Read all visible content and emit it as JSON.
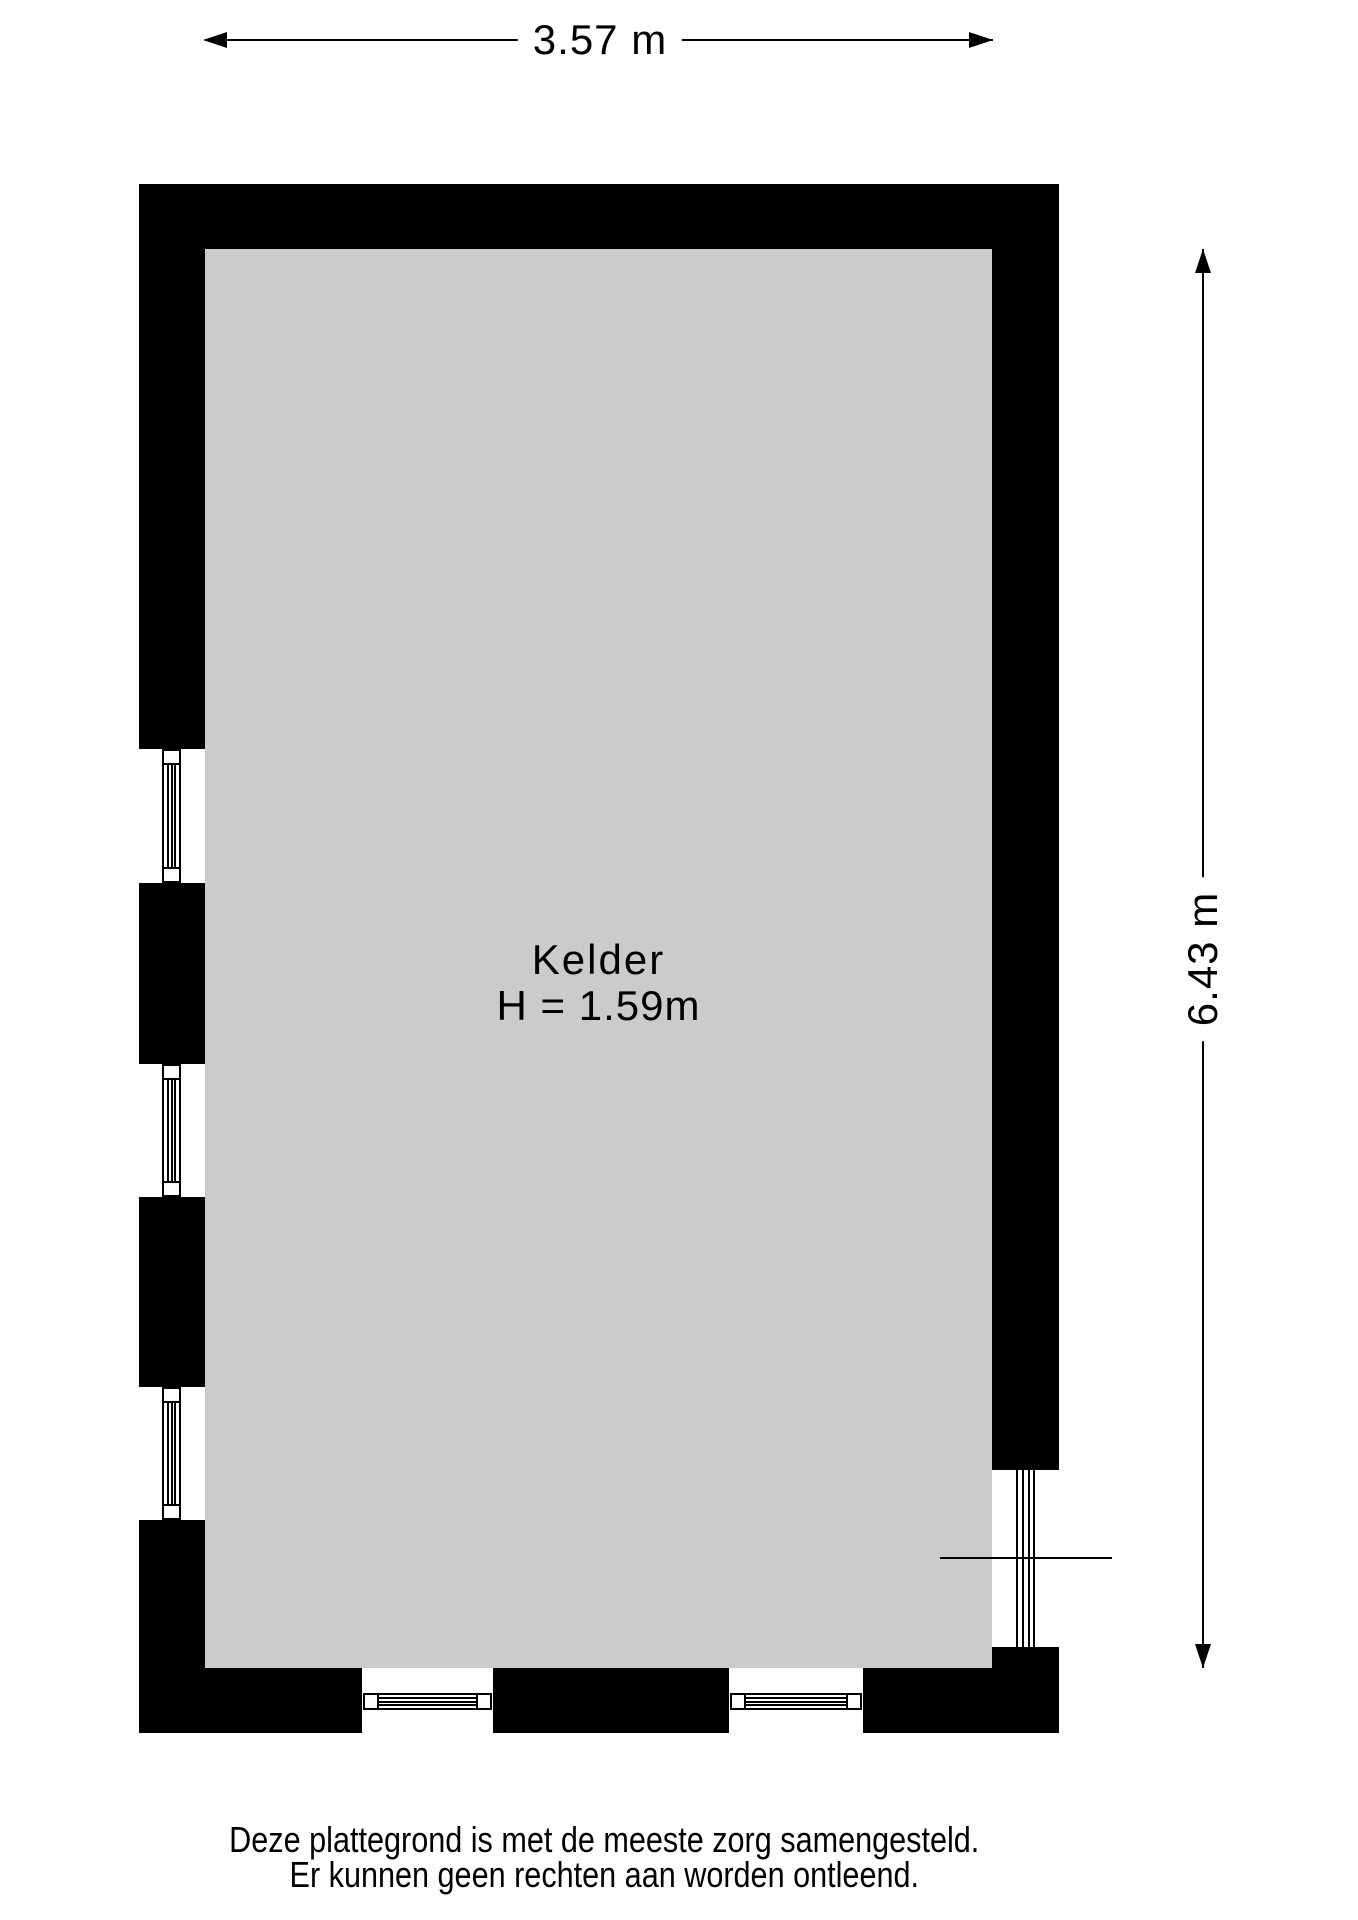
{
  "canvas": {
    "width": 1358,
    "height": 1920
  },
  "colors": {
    "background": "#ffffff",
    "wall": "#000000",
    "floor": "#cbcbcb",
    "line": "#000000",
    "text": "#000000"
  },
  "room": {
    "name": "Kelder",
    "ceiling_height": "H = 1.59m"
  },
  "dimensions": {
    "width": {
      "label": "3.57 m"
    },
    "height": {
      "label": "6.43 m"
    }
  },
  "disclaimer": {
    "line1": "Deze plattegrond is met de meeste zorg samengesteld.",
    "line2": "Er kunnen geen rechten aan worden ontleend."
  },
  "floorplan": {
    "floor": {
      "x": 205,
      "y": 249,
      "w": 787,
      "h": 1419
    },
    "walls": [
      {
        "x": 139,
        "y": 184,
        "w": 920,
        "h": 65
      },
      {
        "x": 139,
        "y": 184,
        "w": 66,
        "h": 565
      },
      {
        "x": 139,
        "y": 883,
        "w": 66,
        "h": 181
      },
      {
        "x": 139,
        "y": 1197,
        "w": 66,
        "h": 190
      },
      {
        "x": 139,
        "y": 1520,
        "w": 66,
        "h": 213
      },
      {
        "x": 992,
        "y": 184,
        "w": 67,
        "h": 1286
      },
      {
        "x": 992,
        "y": 1647,
        "w": 67,
        "h": 86
      },
      {
        "x": 139,
        "y": 1668,
        "w": 223,
        "h": 65
      },
      {
        "x": 493,
        "y": 1668,
        "w": 236,
        "h": 65
      },
      {
        "x": 863,
        "y": 1668,
        "w": 196,
        "h": 65
      }
    ],
    "windows": [
      {
        "orientation": "v",
        "x": 162,
        "y": 749,
        "w": 19,
        "h": 134
      },
      {
        "orientation": "v",
        "x": 162,
        "y": 1064,
        "w": 19,
        "h": 133
      },
      {
        "orientation": "v",
        "x": 162,
        "y": 1387,
        "w": 19,
        "h": 133
      },
      {
        "orientation": "h",
        "x": 363,
        "y": 1693,
        "w": 129,
        "h": 17
      },
      {
        "orientation": "h",
        "x": 730,
        "y": 1693,
        "w": 132,
        "h": 17
      }
    ],
    "stair_lines": [
      {
        "x": 1016,
        "y": 1470,
        "w": 2,
        "h": 177
      },
      {
        "x": 1022,
        "y": 1470,
        "w": 2,
        "h": 177
      },
      {
        "x": 1028,
        "y": 1470,
        "w": 2,
        "h": 177
      },
      {
        "x": 1033,
        "y": 1470,
        "w": 2,
        "h": 177
      }
    ],
    "hatch_line": {
      "x": 940,
      "y": 1557,
      "w": 172,
      "h": 2
    }
  }
}
